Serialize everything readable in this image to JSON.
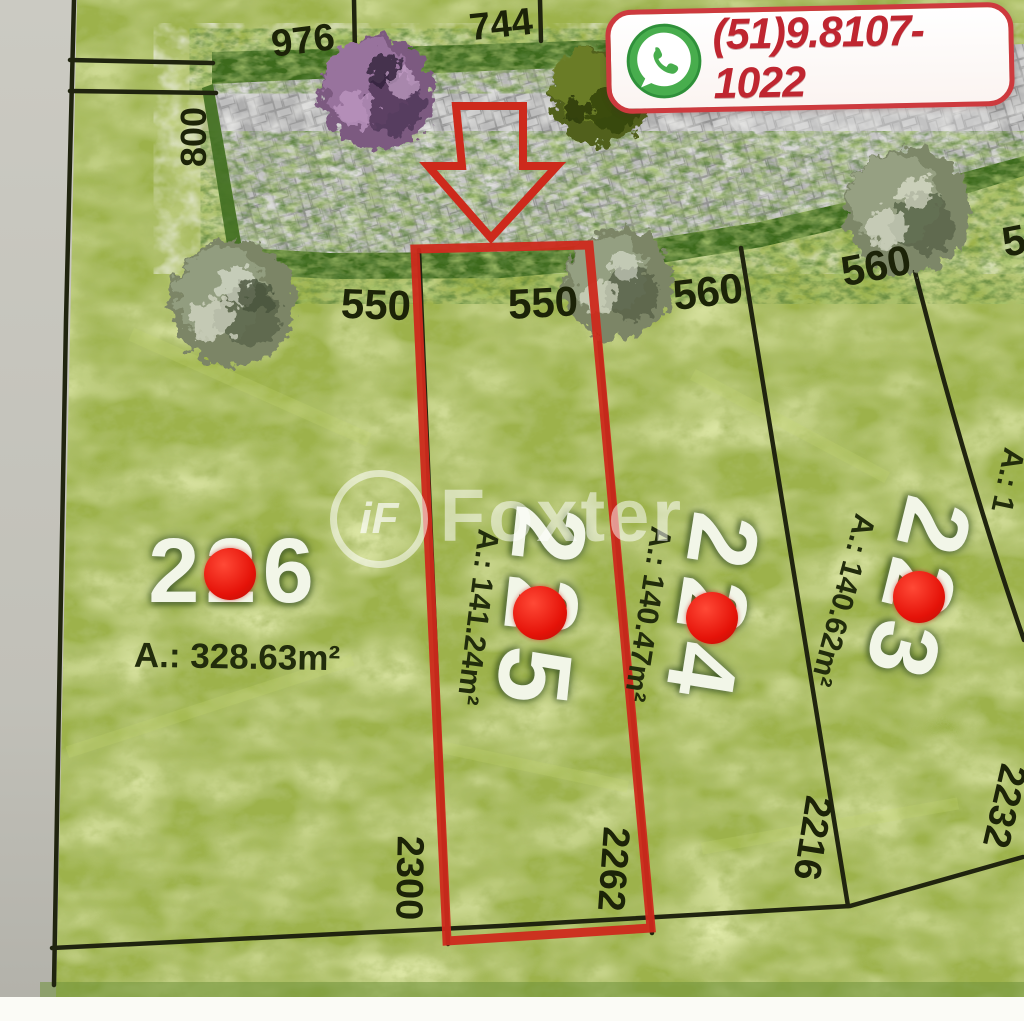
{
  "contact_badge": {
    "phone": "(51)9.8107-1022"
  },
  "watermark": {
    "logo_text": "iF",
    "brand": "Foxter"
  },
  "lots": {
    "lot226": {
      "number": "226",
      "area": "A.: 328.63m²",
      "frontage": "550",
      "depth": "2300"
    },
    "lot225": {
      "number": "225",
      "area": "A.: 141.24m²",
      "frontage": "550",
      "depth": "2262",
      "highlighted": true
    },
    "lot224": {
      "number": "224",
      "area": "A.: 140.47m²",
      "frontage": "560",
      "depth": "2216"
    },
    "lot223": {
      "number": "223",
      "area": "A.: 140.62m²",
      "frontage": "560",
      "depth": "2232"
    }
  },
  "adjacent": {
    "left_lot_width": "800",
    "top_lot_width_a": "976",
    "top_lot_width_b": "744",
    "next_lot_frontage_partial": "5",
    "next_lot_area_partial": "A.: 1"
  },
  "icons": {
    "whatsapp": "phone-in-green-circle",
    "highlight_arrow": "red-outline-down-arrow"
  },
  "colors": {
    "highlight_red": "#cd2a1c",
    "marker_red": "#e51309",
    "grass": "#9db24b",
    "hedge": "#3c6a1d",
    "road_gray": "#b9b9b9",
    "badge_border": "#cd3a3e",
    "badge_text": "#bf2630"
  }
}
